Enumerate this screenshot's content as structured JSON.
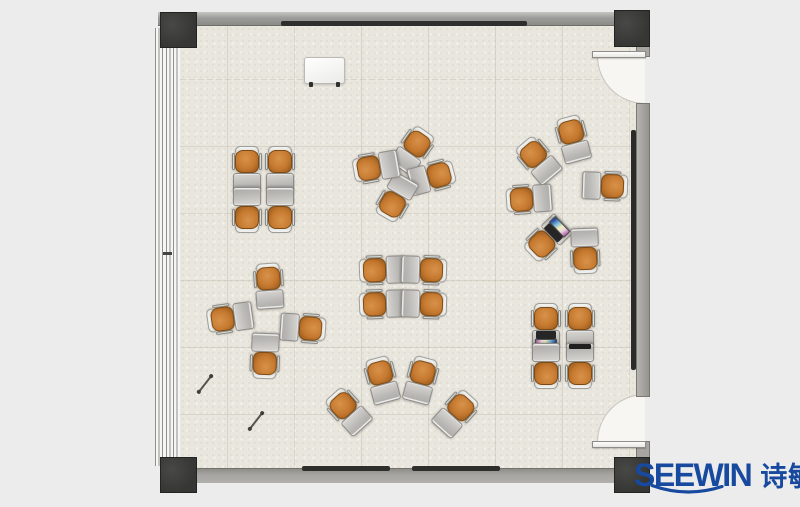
{
  "title": "Classroom floor plan",
  "logo": {
    "brand": "SEEWIN",
    "brand_cn": "诗敏",
    "color": "#17499e"
  },
  "colors": {
    "outside": "#ececec",
    "floor": "#e9e6de",
    "wall": "#9c9c9a",
    "column": "#3a3a38",
    "window_frame": "#8f8f8b",
    "chair_seat": "#c5792f",
    "chair_back": "#e9e9e6",
    "desk": "#bbb9b6",
    "door": "#fdfdfc",
    "rail": "#2e2e2c",
    "logo_blue": "#17499e"
  },
  "furniture": {
    "whiteboard": {
      "x": 304,
      "y": 57,
      "w": 41,
      "h": 27
    },
    "pens": [
      {
        "x": 205,
        "y": 384,
        "rot": -52
      },
      {
        "x": 256,
        "y": 421,
        "rot": -52
      }
    ],
    "clusters": [
      {
        "name": "quad-top-left",
        "units": [
          {
            "x": 247,
            "y": 169,
            "rot": 0
          },
          {
            "x": 280,
            "y": 169,
            "rot": 0
          },
          {
            "x": 247,
            "y": 210,
            "rot": 180
          },
          {
            "x": 280,
            "y": 210,
            "rot": 180
          }
        ]
      },
      {
        "name": "pinwheel-top-center",
        "units": [
          {
            "x": 413,
            "y": 150,
            "rot": 35
          },
          {
            "x": 432,
            "y": 177,
            "rot": 75
          },
          {
            "x": 396,
            "y": 198,
            "rot": 210
          },
          {
            "x": 376,
            "y": 167,
            "rot": 260
          }
        ]
      },
      {
        "name": "circle-right",
        "units": [
          {
            "x": 573,
            "y": 139,
            "rot": -15
          },
          {
            "x": 538,
            "y": 160,
            "rot": -40
          },
          {
            "x": 529,
            "y": 199,
            "rot": 266
          },
          {
            "x": 547,
            "y": 239,
            "rot": 226,
            "acc": "laptop"
          },
          {
            "x": 585,
            "y": 251,
            "rot": 178
          },
          {
            "x": 605,
            "y": 186,
            "rot": 92
          }
        ]
      },
      {
        "name": "cross-middle-left",
        "units": [
          {
            "x": 269,
            "y": 286,
            "rot": -4
          },
          {
            "x": 230,
            "y": 318,
            "rot": 262
          },
          {
            "x": 303,
            "y": 328,
            "rot": 94
          },
          {
            "x": 265,
            "y": 356,
            "rot": 182
          }
        ]
      },
      {
        "name": "quad-center",
        "units": [
          {
            "x": 382,
            "y": 270,
            "rot": 268
          },
          {
            "x": 424,
            "y": 270,
            "rot": 92
          },
          {
            "x": 382,
            "y": 304,
            "rot": 268
          },
          {
            "x": 424,
            "y": 304,
            "rot": 92
          }
        ]
      },
      {
        "name": "fan-bottom-center",
        "units": [
          {
            "x": 348,
            "y": 411,
            "rot": -42
          },
          {
            "x": 382,
            "y": 380,
            "rot": -15
          },
          {
            "x": 421,
            "y": 380,
            "rot": 15
          },
          {
            "x": 456,
            "y": 413,
            "rot": 42
          }
        ]
      },
      {
        "name": "quad-bottom-right",
        "units": [
          {
            "x": 546,
            "y": 326,
            "rot": 0,
            "acc": "laptop"
          },
          {
            "x": 580,
            "y": 326,
            "rot": 0
          },
          {
            "x": 546,
            "y": 366,
            "rot": 180
          },
          {
            "x": 580,
            "y": 366,
            "rot": 180,
            "acc": "tablet"
          }
        ]
      }
    ]
  }
}
